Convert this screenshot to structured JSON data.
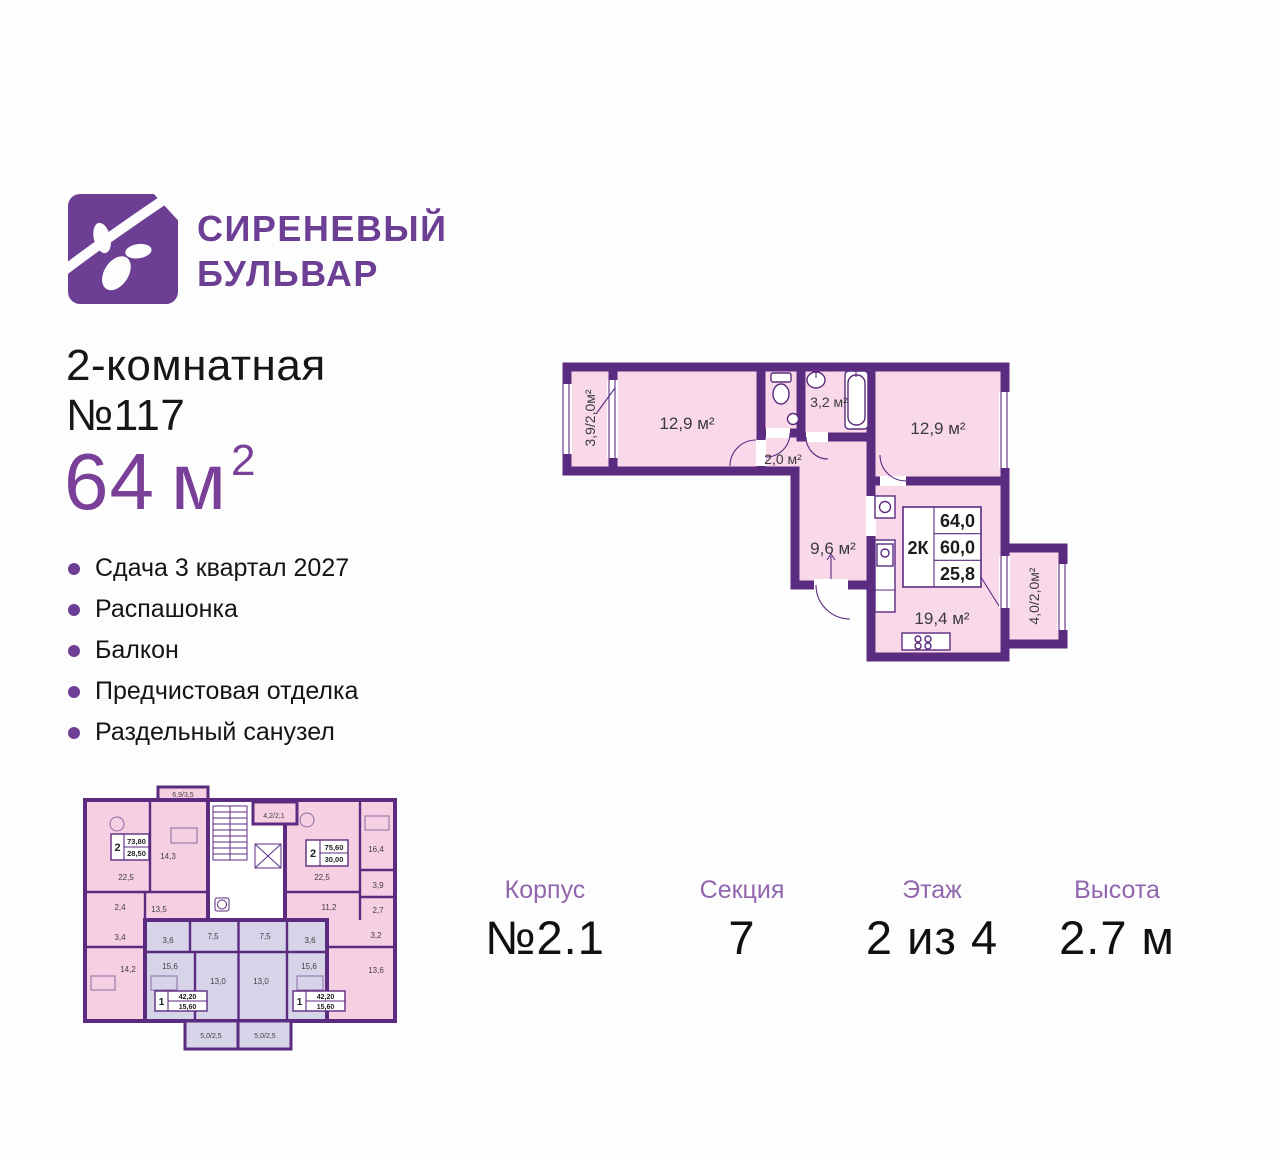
{
  "brand": {
    "line1": "СИРЕНЕВЫЙ",
    "line2": "БУЛЬВАР"
  },
  "listing": {
    "type": "2-комнатная",
    "number": "№117",
    "area_value": "64",
    "area_unit": "м",
    "area_sup": "2"
  },
  "features": [
    "Сдача 3 квартал 2027",
    "Распашонка",
    "Балкон",
    "Предчистовая отделка",
    "Раздельный санузел"
  ],
  "main_plan": {
    "balcony_left": "3,9/2,0м²",
    "room_left": "12,9 м²",
    "hall": "2,0 м²",
    "bathroom": "3,2 м²",
    "room_right": "12,9 м²",
    "corridor": "9,6 м²",
    "kitchen_living": "19,4 м²",
    "balcony_right": "4,0/2,0м²",
    "info": {
      "type": "2К",
      "area_total": "64,0",
      "area_living": "60,0",
      "area_kitchen": "25,8"
    }
  },
  "small_plan": {
    "apt2_left": {
      "badge": "2",
      "area_total": "73,80",
      "area_living": "28,50",
      "balcony_top": "6,9/3,5",
      "bedroom": "14,3",
      "kitchen_living": "22,5",
      "bath": "2,4",
      "corridor": "13,5",
      "wc": "3,4",
      "room2": "14,2"
    },
    "apt2_right": {
      "badge": "2",
      "area_total": "75,60",
      "area_living": "30,00",
      "balcony": "4,2/2,1",
      "bedroom": "16,4",
      "kitchen_living": "22,5",
      "room_39": "3,9",
      "corridor": "11,2",
      "room_27": "2,7",
      "room_32": "3,2",
      "room_136": "13,6"
    },
    "apt1_left": {
      "badge": "1",
      "area_total": "42,20",
      "area_living": "15,60",
      "bath": "3,6",
      "hall": "7,5",
      "room": "15,6",
      "kitchen": "13,0",
      "balcony": "5,0/2,5"
    },
    "apt1_right": {
      "badge": "1",
      "area_total": "42,20",
      "area_living": "15,60",
      "bath": "3,6",
      "hall": "7,5",
      "room": "15,6",
      "kitchen": "13,0",
      "balcony": "5,0/2,5"
    }
  },
  "details": [
    {
      "label": "Корпус",
      "value": "№2.1"
    },
    {
      "label": "Секция",
      "value": "7"
    },
    {
      "label": "Этаж",
      "value": "2 из 4"
    },
    {
      "label": "Высота",
      "value": "2.7 м"
    }
  ],
  "colors": {
    "brand_purple": "#6d3f94",
    "wall_purple": "#5b2b80",
    "room_pink": "#f8d8e9",
    "unit_lavender": "#d7d4e9",
    "label_purple": "#9166ae",
    "area_purple": "#7a3f98"
  }
}
